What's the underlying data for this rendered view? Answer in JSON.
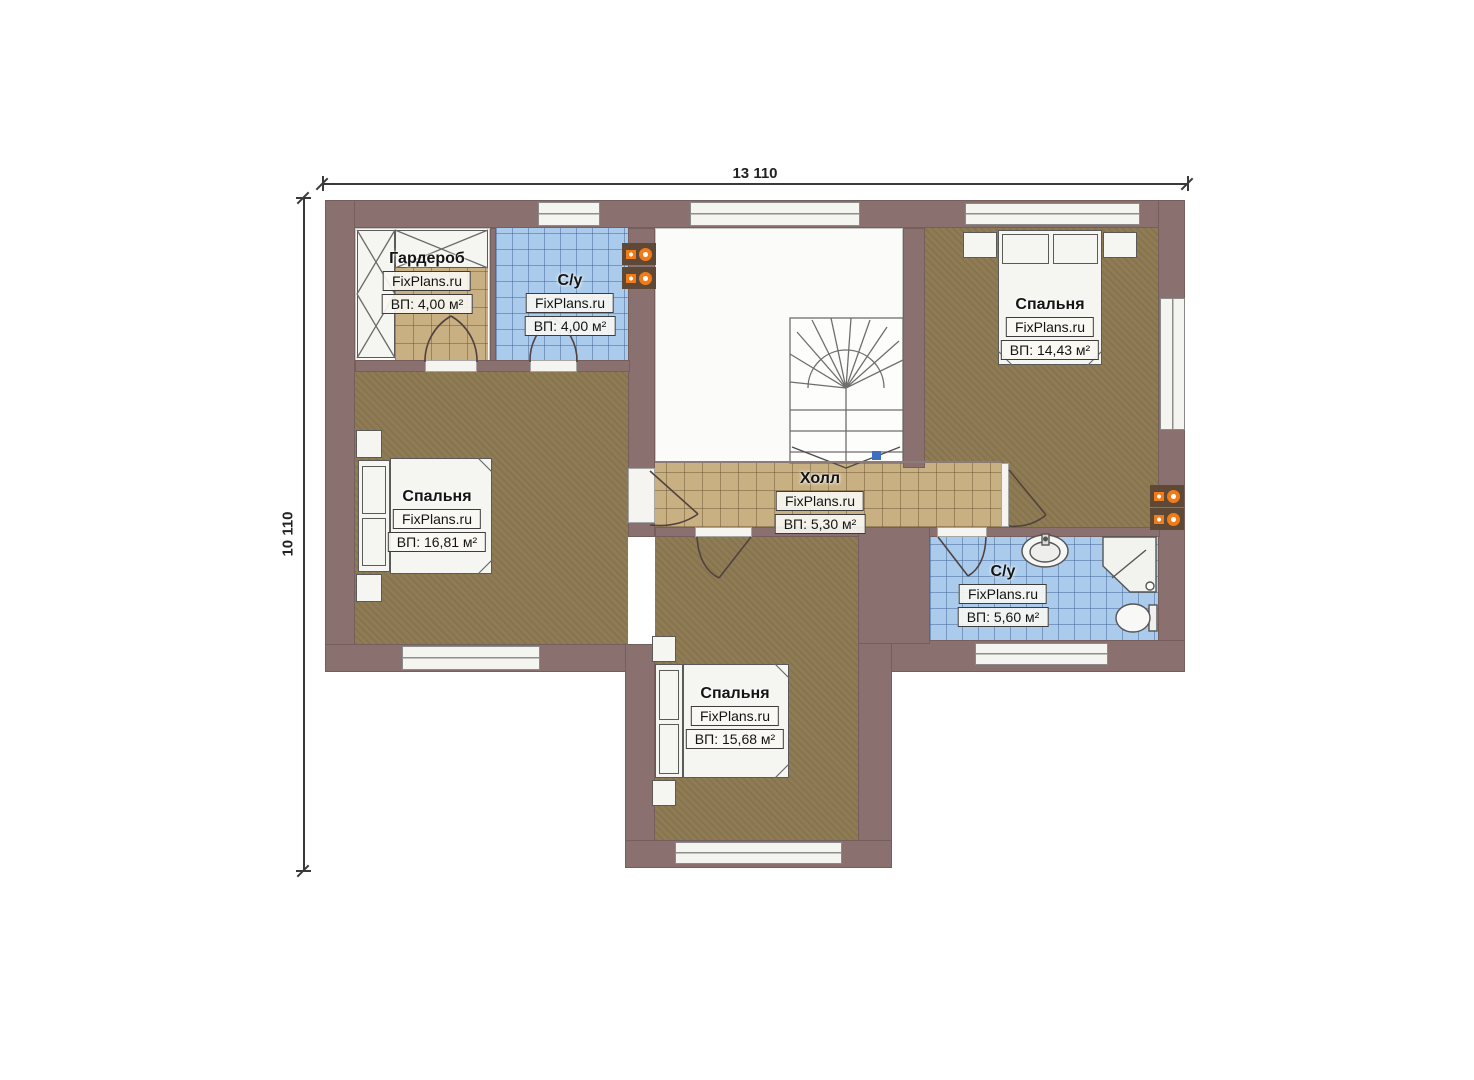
{
  "watermark": "FixPlans.ru",
  "dimensions": {
    "width_label": "13 110",
    "height_label": "10 110"
  },
  "rooms": [
    {
      "name": "Гардероб",
      "brand": "FixPlans.ru",
      "area": "ВП: 4,00 м²"
    },
    {
      "name": "С/у",
      "brand": "FixPlans.ru",
      "area": "ВП: 4,00 м²"
    },
    {
      "name": "Спальня",
      "brand": "FixPlans.ru",
      "area": "ВП: 14,43 м²"
    },
    {
      "name": "Спальня",
      "brand": "FixPlans.ru",
      "area": "ВП: 16,81 м²"
    },
    {
      "name": "Холл",
      "brand": "FixPlans.ru",
      "area": "ВП: 5,30 м²"
    },
    {
      "name": "С/у",
      "brand": "FixPlans.ru",
      "area": "ВП: 5,60 м²"
    },
    {
      "name": "Спальня",
      "brand": "FixPlans.ru",
      "area": "ВП: 15,68 м²"
    }
  ],
  "colors": {
    "wall": "#8a7170",
    "floor_brown": "#8f7c55",
    "tile_tan": "#c8b082",
    "tile_blue": "#aacbec",
    "fixture": "#f5f5f2",
    "vent_orange": "#f27a17",
    "dimension": "#3a3a3a"
  }
}
